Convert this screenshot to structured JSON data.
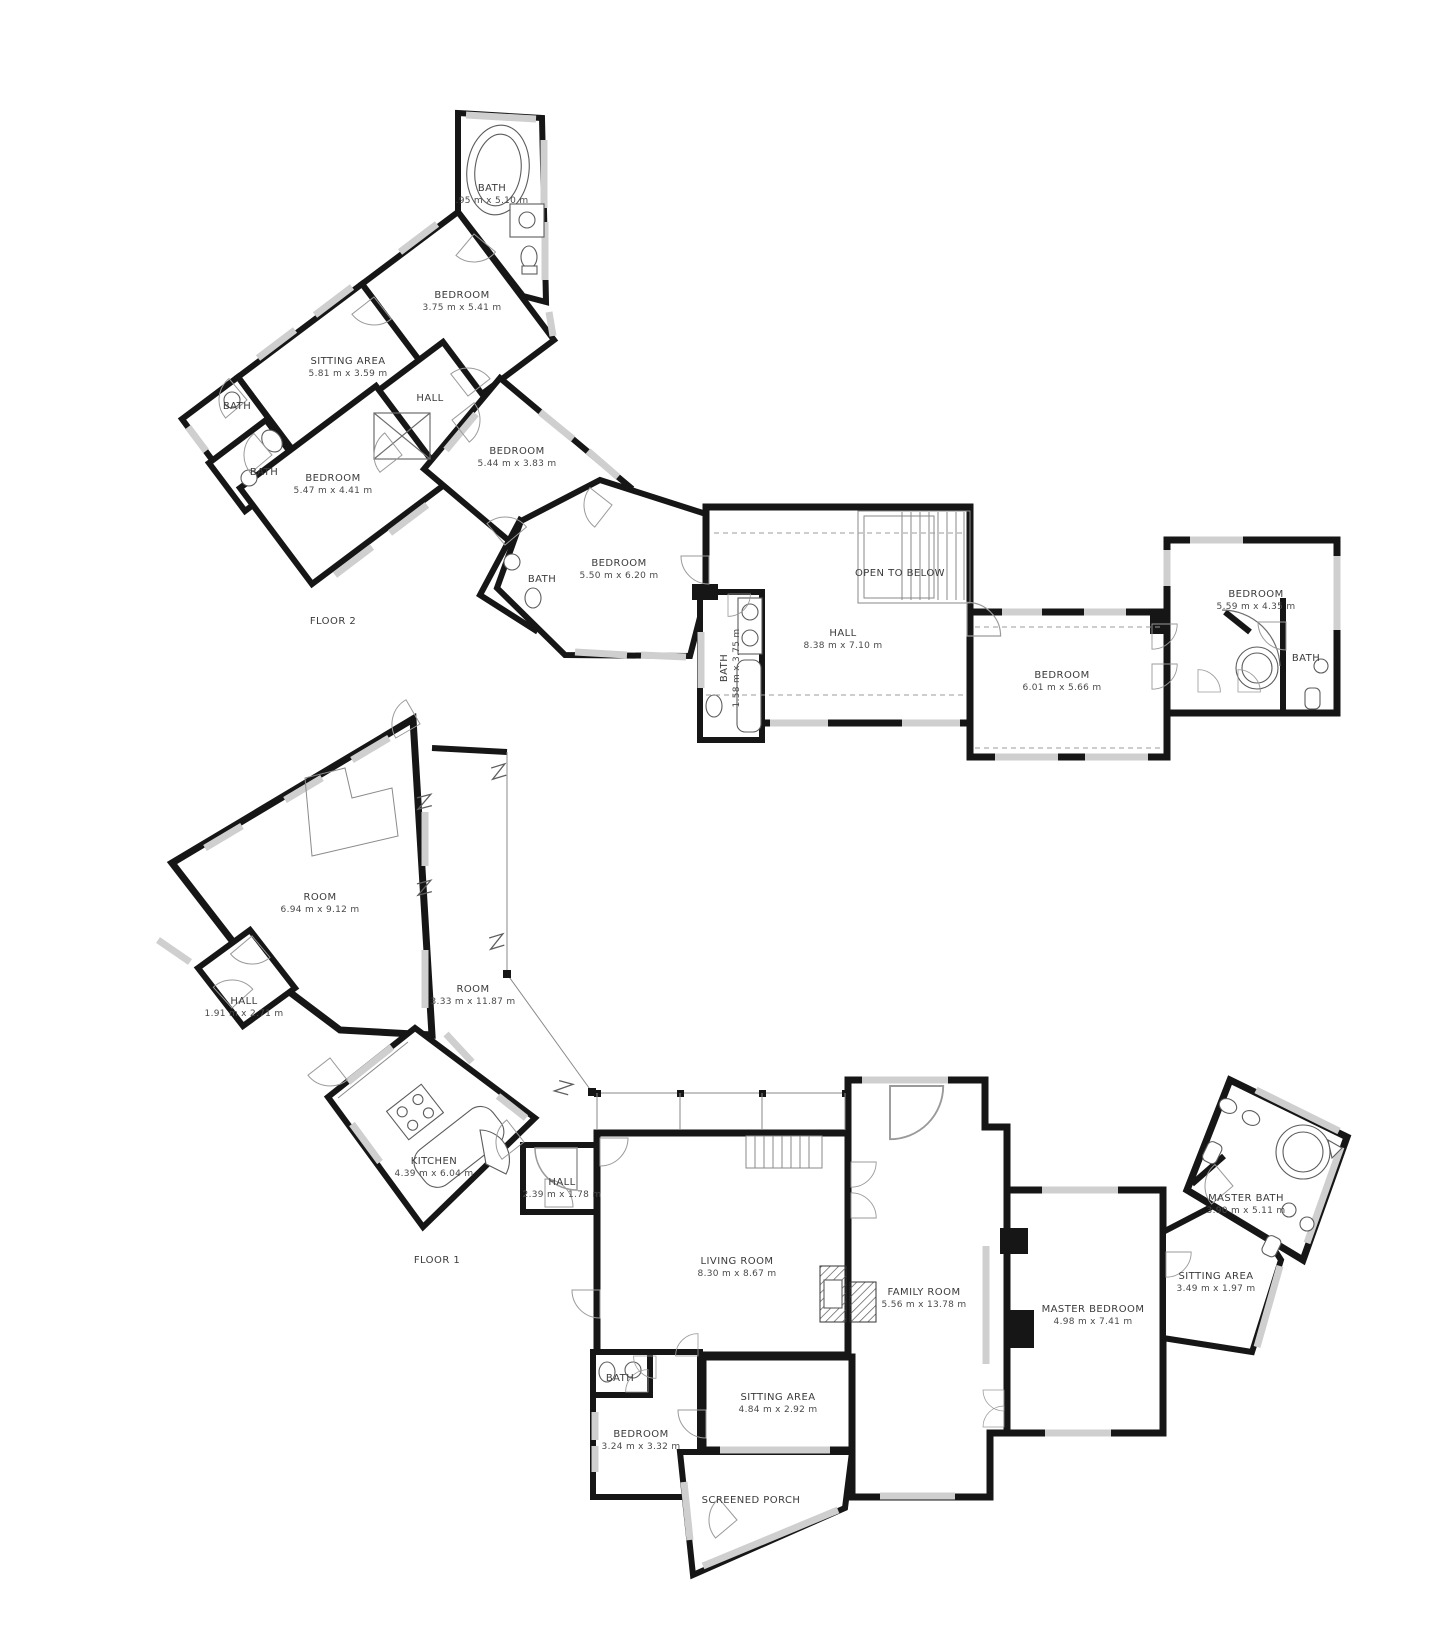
{
  "document": {
    "type": "floor-plan",
    "background": "#ffffff",
    "wall_color": "#161616",
    "window_color": "#cfcfcf",
    "text_color": "#3b3b3b",
    "icons": [
      "bathtub-icon",
      "round-tub-icon",
      "sink-icon",
      "toilet-icon",
      "stove-icon",
      "kitchen-island-icon",
      "stairs-icon",
      "elevator-icon",
      "fireplace-icon",
      "door-swing-icon",
      "break-line-icon"
    ]
  },
  "floors": [
    {
      "name": "FLOOR 2",
      "rooms": [
        {
          "label": "BATH",
          "dims": ".95 m x 5.10 m"
        },
        {
          "label": "BEDROOM",
          "dims": "3.75 m x 5.41 m"
        },
        {
          "label": "SITTING AREA",
          "dims": "5.81 m x 3.59 m"
        },
        {
          "label": "BATH",
          "dims": ""
        },
        {
          "label": "BATH",
          "dims": ""
        },
        {
          "label": "HALL",
          "dims": ""
        },
        {
          "label": "BEDROOM",
          "dims": "5.47 m x 4.41 m"
        },
        {
          "label": "BEDROOM",
          "dims": "5.44 m x 3.83 m"
        },
        {
          "label": "BATH",
          "dims": ""
        },
        {
          "label": "BEDROOM",
          "dims": "5.50 m x 6.20 m"
        },
        {
          "label": "BATH",
          "dims": "1.58 m x 3.75 m"
        },
        {
          "label": "OPEN TO BELOW",
          "dims": ""
        },
        {
          "label": "HALL",
          "dims": "8.38 m x 7.10 m"
        },
        {
          "label": "BEDROOM",
          "dims": "6.01 m x 5.66 m"
        },
        {
          "label": "BEDROOM",
          "dims": "5.59 m x 4.35 m"
        },
        {
          "label": "BATH",
          "dims": ""
        }
      ]
    },
    {
      "name": "FLOOR 1",
      "rooms": [
        {
          "label": "ROOM",
          "dims": "6.94 m x 9.12 m"
        },
        {
          "label": "HALL",
          "dims": "1.91 m x 2.71 m"
        },
        {
          "label": "ROOM",
          "dims": "3.33 m x 11.87 m"
        },
        {
          "label": "KITCHEN",
          "dims": "4.39 m x 6.04 m"
        },
        {
          "label": "HALL",
          "dims": "2.39 m x 1.78 m"
        },
        {
          "label": "LIVING ROOM",
          "dims": "8.30 m x 8.67 m"
        },
        {
          "label": "FAMILY ROOM",
          "dims": "5.56 m x 13.78 m"
        },
        {
          "label": "MASTER BEDROOM",
          "dims": "4.98 m x 7.41 m"
        },
        {
          "label": "SITTING AREA",
          "dims": "3.49 m x 1.97 m"
        },
        {
          "label": "MASTER BATH",
          "dims": "3.90 m x 5.11 m"
        },
        {
          "label": "BATH",
          "dims": ""
        },
        {
          "label": "BEDROOM",
          "dims": "3.24 m x 3.32 m"
        },
        {
          "label": "SITTING AREA",
          "dims": "4.84 m x 2.92 m"
        },
        {
          "label": "SCREENED PORCH",
          "dims": ""
        }
      ]
    }
  ]
}
